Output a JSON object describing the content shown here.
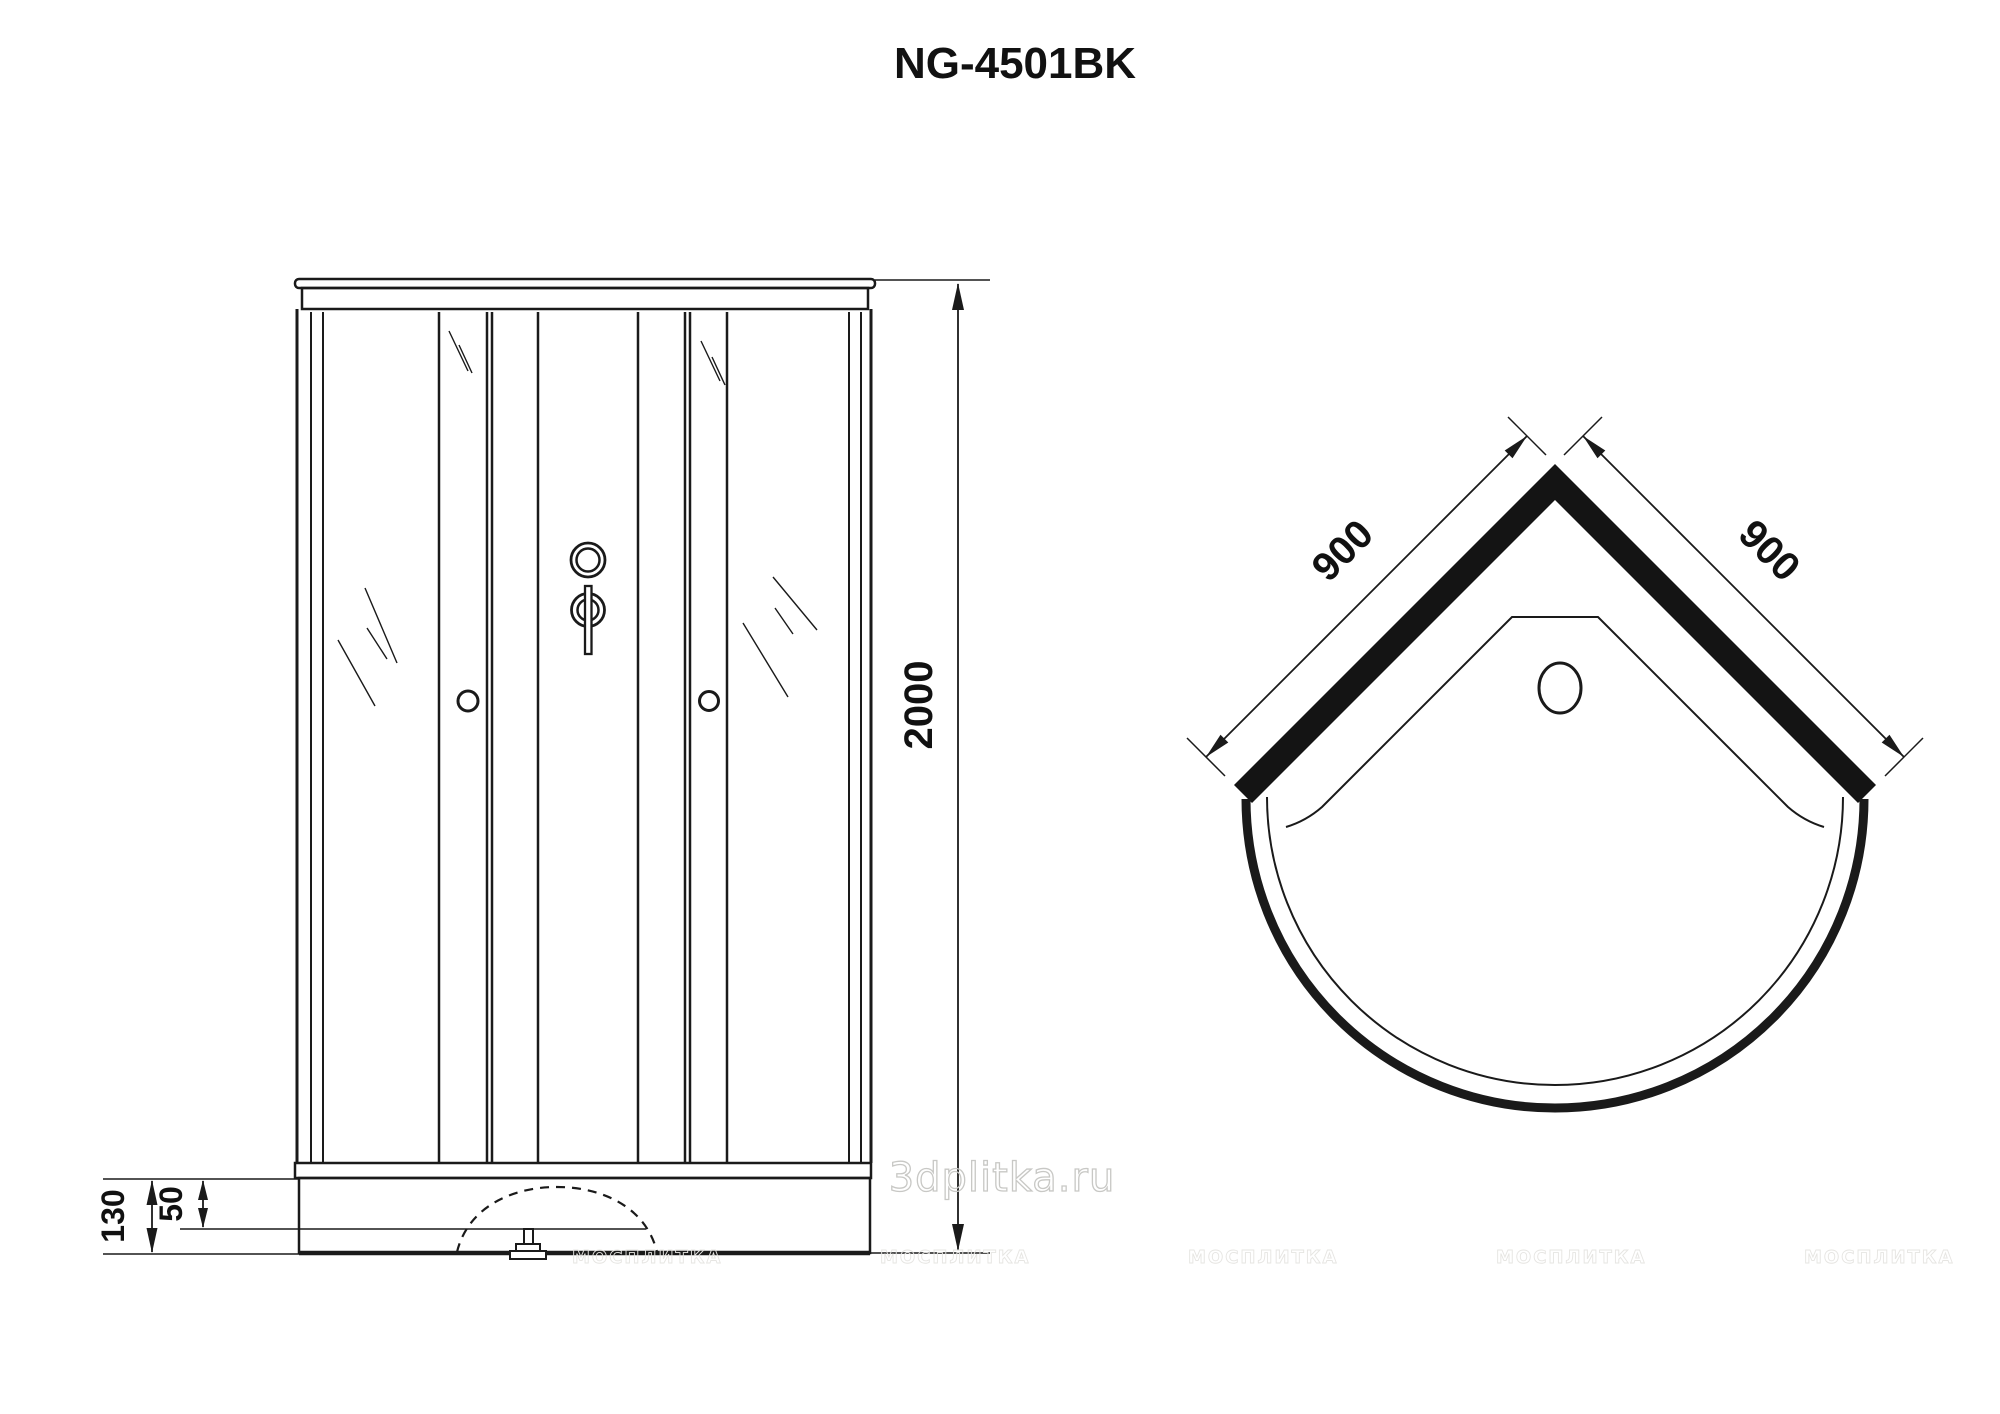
{
  "title": "NG-4501BK",
  "front_view": {
    "height_mm": "2000",
    "base_height_mm": "130",
    "tray_inner_height_mm": "50"
  },
  "top_view": {
    "side_left_mm": "900",
    "side_right_mm": "900"
  },
  "watermarks": {
    "center": "3dplitka.ru",
    "tile": "МОСПЛИТКА"
  }
}
